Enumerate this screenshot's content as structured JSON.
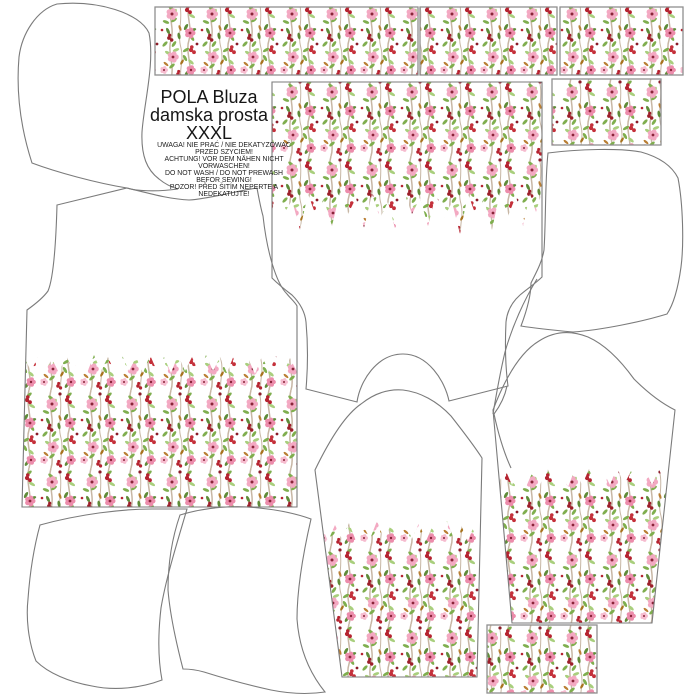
{
  "pattern_label": {
    "product_line1": "POLA Bluza",
    "product_line2": "damska prosta",
    "size": "XXXL",
    "care_lines": [
      "UWAGA! NIE PRAĆ / NIE DEKATYZOWAĆ",
      "PRZED SZYCIEM!",
      "ACHTUNG! VOR DEM NÄHEN NICHT",
      "VORWASCHEN!",
      "DO NOT WASH / DO NOT PREWASH",
      "BEFOR SEWING!",
      "POZOR! PŘED ŠITÍM NEPERTE A",
      "NEDEKATUJTE!"
    ]
  },
  "colors": {
    "outline": "#7b7b7b",
    "rect_border": "#8f8f8f",
    "background": "#ffffff",
    "floral_palette": {
      "pink_light": "#f3a9c2",
      "pink_deep": "#ec8cab",
      "red": "#b52330",
      "red_bright": "#c4303a",
      "red_dark": "#8c1c28",
      "green": "#7fae4e",
      "green_light": "#a9cf7d",
      "green_dark": "#5f8c39",
      "ochre": "#b97e33",
      "stem": "#c7b6a4"
    }
  }
}
